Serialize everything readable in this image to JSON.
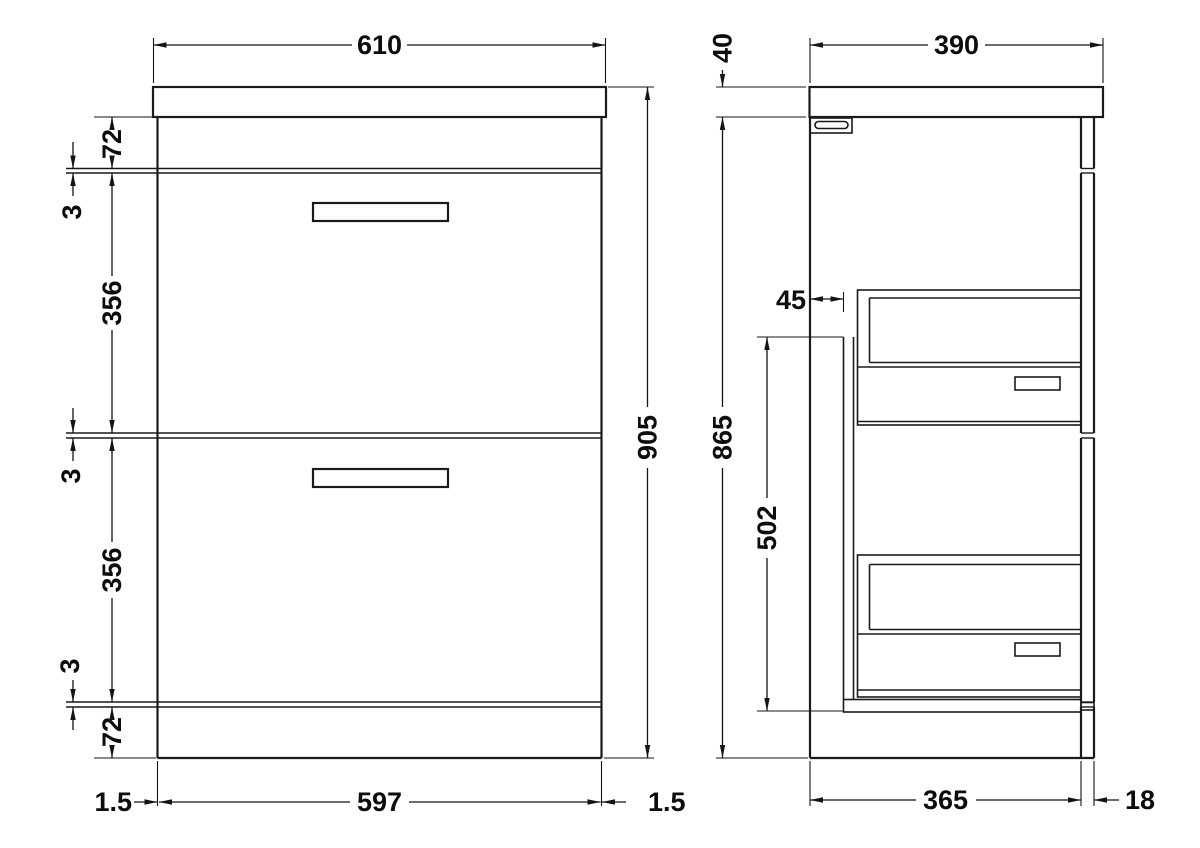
{
  "colors": {
    "line": "#1a1a1a",
    "background": "#ffffff"
  },
  "front_view": {
    "dim_width_top": "610",
    "dim_top_rail": "72",
    "dim_gap_1": "3",
    "dim_drawer_1": "356",
    "dim_gap_2": "3",
    "dim_drawer_2": "356",
    "dim_gap_3": "3",
    "dim_bottom_rail": "72",
    "dim_height_total": "905",
    "dim_inset_left": "1.5",
    "dim_width_drawers": "597",
    "dim_inset_right": "1.5"
  },
  "side_view": {
    "dim_depth_top": "390",
    "dim_worktop_thickness": "40",
    "dim_height_cabinet": "865",
    "dim_back_gap": "45",
    "dim_runner_space": "502",
    "dim_depth_cabinet": "365",
    "dim_front_thickness": "18"
  }
}
